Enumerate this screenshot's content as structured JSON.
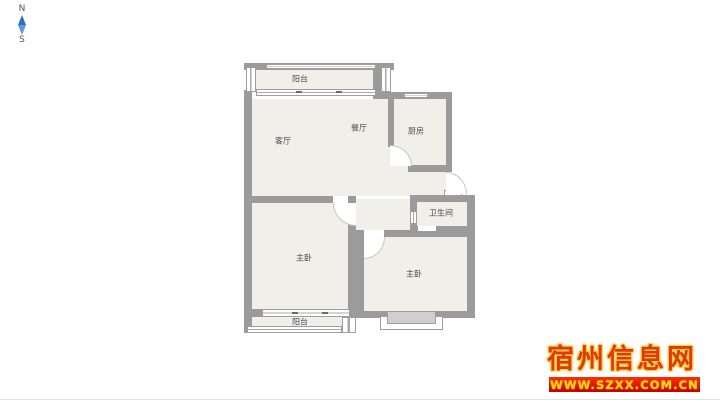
{
  "compass": {
    "north_label": "N",
    "south_label": "S"
  },
  "floorplan": {
    "rooms": [
      {
        "name": "balcony-top",
        "label": "阳台"
      },
      {
        "name": "living-room",
        "label": "客厅"
      },
      {
        "name": "dining-room",
        "label": "餐厅"
      },
      {
        "name": "kitchen",
        "label": "厨房"
      },
      {
        "name": "bathroom",
        "label": "卫生间"
      },
      {
        "name": "bedroom-left",
        "label": "主卧"
      },
      {
        "name": "bedroom-right",
        "label": "主卧"
      },
      {
        "name": "balcony-bottom",
        "label": "阳台"
      }
    ]
  },
  "watermark": {
    "site_name": "宿州信息网",
    "site_url": "www.szxx.com.cn"
  },
  "colors": {
    "wall": "#9b9b9b",
    "room_fill": "#f1efea",
    "bay_window_fill": "#cfcfcf",
    "compass_blue_dark": "#2b72b8",
    "compass_blue_light": "#5d9bd0",
    "watermark_red": "#dd3912",
    "watermark_gold": "#ffcf3e",
    "banner_red": "#c40000",
    "banner_text": "#ffd800"
  }
}
